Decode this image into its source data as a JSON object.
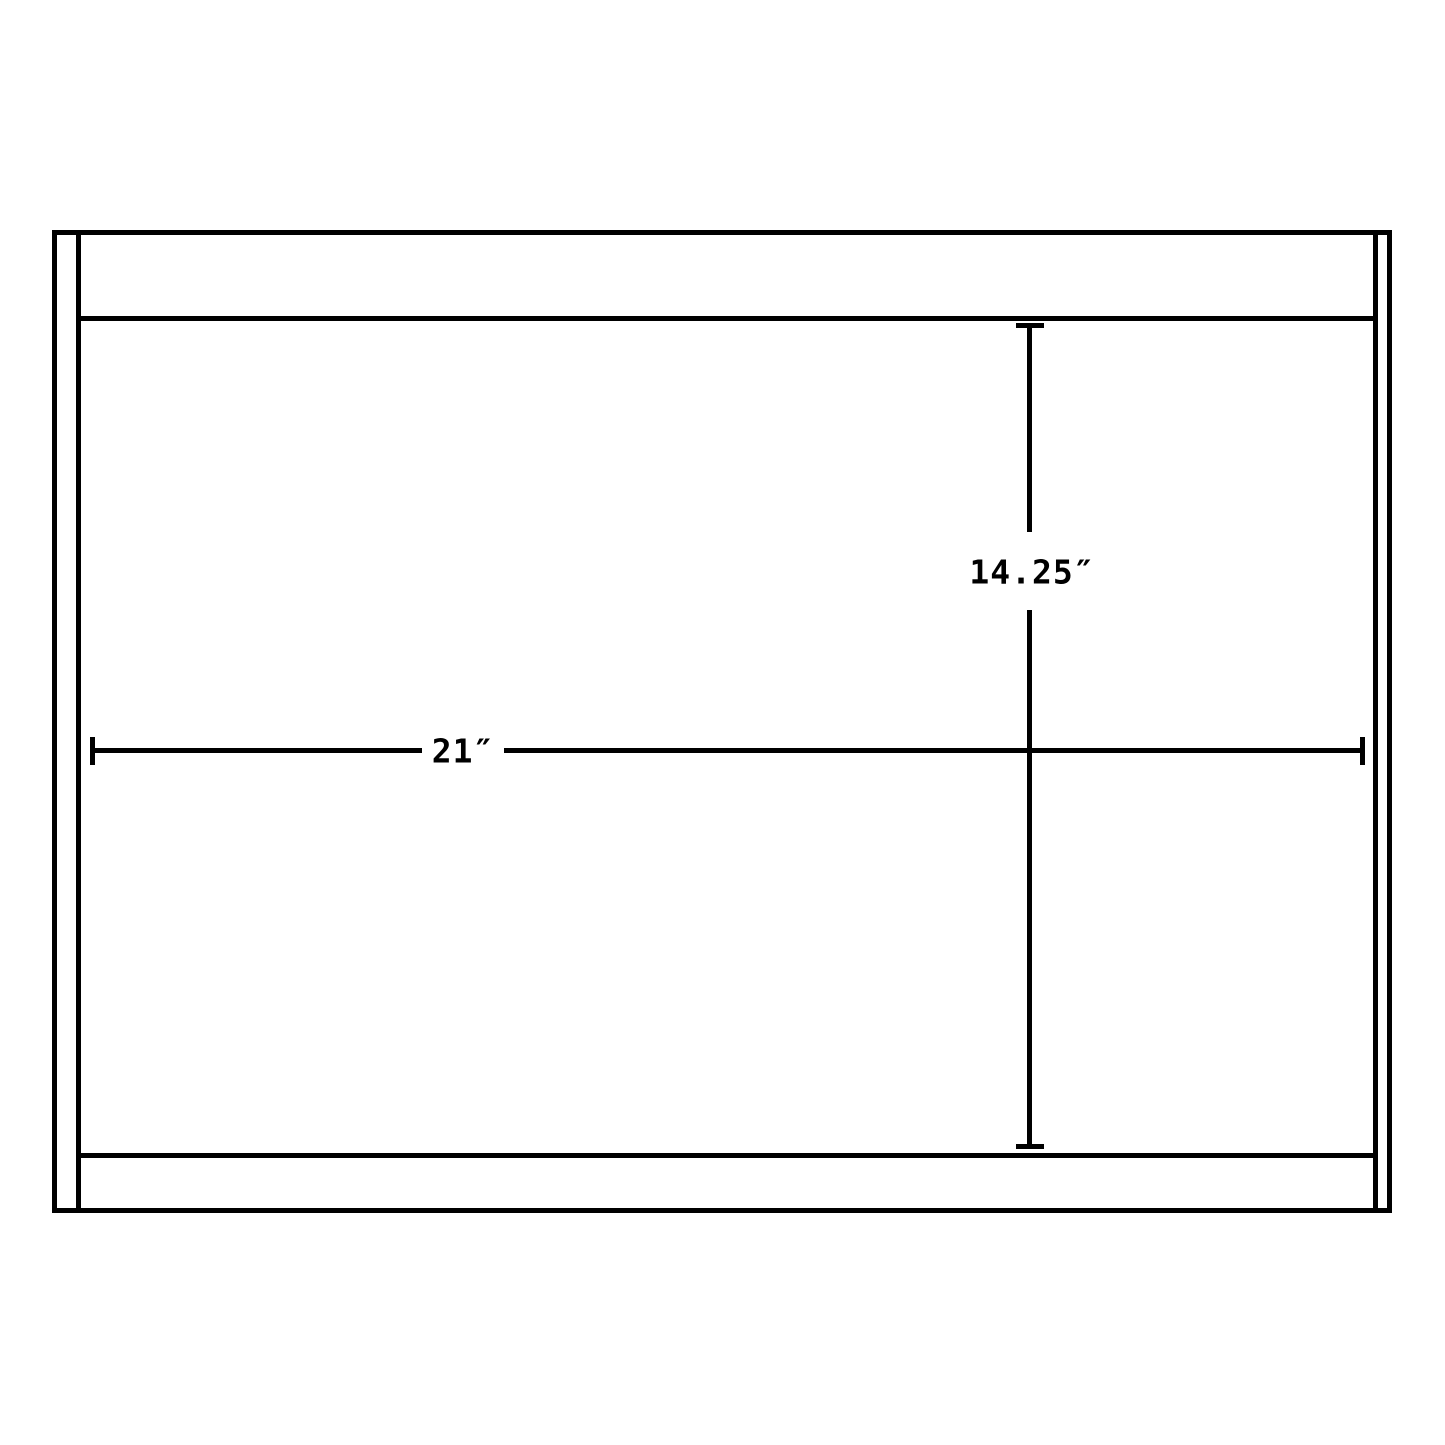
{
  "page": {
    "background_color": "#ffffff",
    "line_color": "#000000"
  },
  "diagram": {
    "type": "dimension-drawing",
    "subject": "cabinet-front-outline",
    "width_dimension": {
      "label": "21″",
      "value_inches": 21
    },
    "height_dimension": {
      "label": "14.25″",
      "value_inches": 14.25
    }
  }
}
